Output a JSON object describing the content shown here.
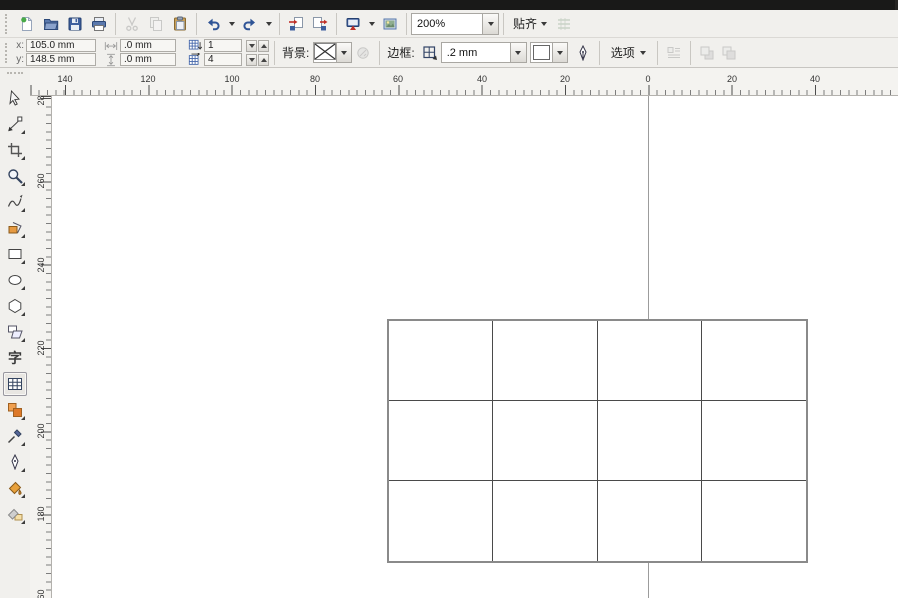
{
  "toolbar": {
    "zoom_level": "200%",
    "snap_label": "贴齐",
    "buttons": [
      {
        "name": "new-document-button",
        "icon": "new-doc"
      },
      {
        "name": "open-button",
        "icon": "open-folder"
      },
      {
        "name": "save-button",
        "icon": "save"
      },
      {
        "name": "print-button",
        "icon": "print"
      },
      {
        "sep": true
      },
      {
        "name": "cut-button",
        "icon": "cut",
        "disabled": true
      },
      {
        "name": "copy-button",
        "icon": "copy",
        "disabled": true
      },
      {
        "name": "paste-button",
        "icon": "paste"
      },
      {
        "sep": true
      },
      {
        "name": "undo-button",
        "icon": "undo",
        "caret": true
      },
      {
        "name": "redo-button",
        "icon": "redo",
        "caret": true
      },
      {
        "sep": true
      },
      {
        "name": "import-button",
        "icon": "import"
      },
      {
        "name": "export-button",
        "icon": "export"
      },
      {
        "sep": true
      },
      {
        "name": "application-launcher-button",
        "icon": "app-launcher",
        "caret": true
      },
      {
        "name": "welcome-screen-button",
        "icon": "welcome"
      },
      {
        "sep": true
      },
      {
        "type": "zoom-combo"
      },
      {
        "sep": true
      },
      {
        "type": "snap-dropdown"
      },
      {
        "name": "snap-settings-button",
        "icon": "snap-settings",
        "disabled": true
      }
    ]
  },
  "property_bar": {
    "x_label": "x:",
    "x_value": "105.0 mm",
    "y_label": "y:",
    "y_value": "148.5 mm",
    "width_value": ".0 mm",
    "height_value": ".0 mm",
    "rows_value": "1",
    "columns_value": "4",
    "background_label": "背景:",
    "border_label": "边框:",
    "border_width_value": ".2 mm",
    "border_color": "#1a1a1a",
    "options_label": "选项"
  },
  "rulers": {
    "unit_spacing_px": 83.33,
    "horizontal": {
      "labels": [
        "140",
        "120",
        "100",
        "80",
        "60",
        "40",
        "20",
        "0",
        "20",
        "40"
      ],
      "positions": [
        35,
        118,
        202,
        285,
        368,
        452,
        535,
        618,
        702,
        785
      ]
    },
    "vertical": {
      "labels": [
        "280",
        "260",
        "240",
        "220",
        "200",
        "180",
        "160"
      ],
      "positions": [
        2,
        85,
        169,
        252,
        335,
        418,
        501
      ]
    }
  },
  "toolbox": {
    "text_tool_glyph": "字",
    "tools": [
      {
        "name": "pick-tool",
        "icon": "pick",
        "flyout": false
      },
      {
        "name": "shape-tool",
        "icon": "shape",
        "flyout": true
      },
      {
        "name": "crop-tool",
        "icon": "crop",
        "flyout": true
      },
      {
        "name": "zoom-tool",
        "icon": "zoom",
        "flyout": true
      },
      {
        "name": "freehand-tool",
        "icon": "freehand",
        "flyout": true
      },
      {
        "name": "smart-fill-tool",
        "icon": "smart-fill",
        "flyout": true
      },
      {
        "name": "rectangle-tool",
        "icon": "rectangle",
        "flyout": true
      },
      {
        "name": "ellipse-tool",
        "icon": "ellipse",
        "flyout": true
      },
      {
        "name": "polygon-tool",
        "icon": "polygon",
        "flyout": true
      },
      {
        "name": "basic-shapes-tool",
        "icon": "basic-shapes",
        "flyout": true
      },
      {
        "name": "text-tool",
        "icon": "text",
        "flyout": false
      },
      {
        "name": "table-tool",
        "icon": "table",
        "flyout": false,
        "selected": true
      },
      {
        "name": "blend-tool",
        "icon": "blend",
        "flyout": true
      },
      {
        "name": "eyedropper-tool",
        "icon": "eyedropper",
        "flyout": true
      },
      {
        "name": "outline-pen-tool",
        "icon": "outline-pen",
        "flyout": true
      },
      {
        "name": "fill-tool",
        "icon": "fill",
        "flyout": true
      },
      {
        "name": "interactive-fill-tool",
        "icon": "interactive-fill",
        "flyout": true
      }
    ]
  },
  "canvas": {
    "guideline_x": 596,
    "table": {
      "left": 335,
      "top": 223,
      "width": 421,
      "height": 244,
      "rows": 3,
      "columns": 4,
      "outer_border_color": "#8a8a8a",
      "inner_border_color": "#4a4a4a",
      "fill": "#ffffff"
    }
  },
  "colors": {
    "chrome": "#f1f0ed",
    "ruler_bg": "#f4f3f0",
    "accent_blue": "#2f5496",
    "title_strip": "#191918"
  }
}
